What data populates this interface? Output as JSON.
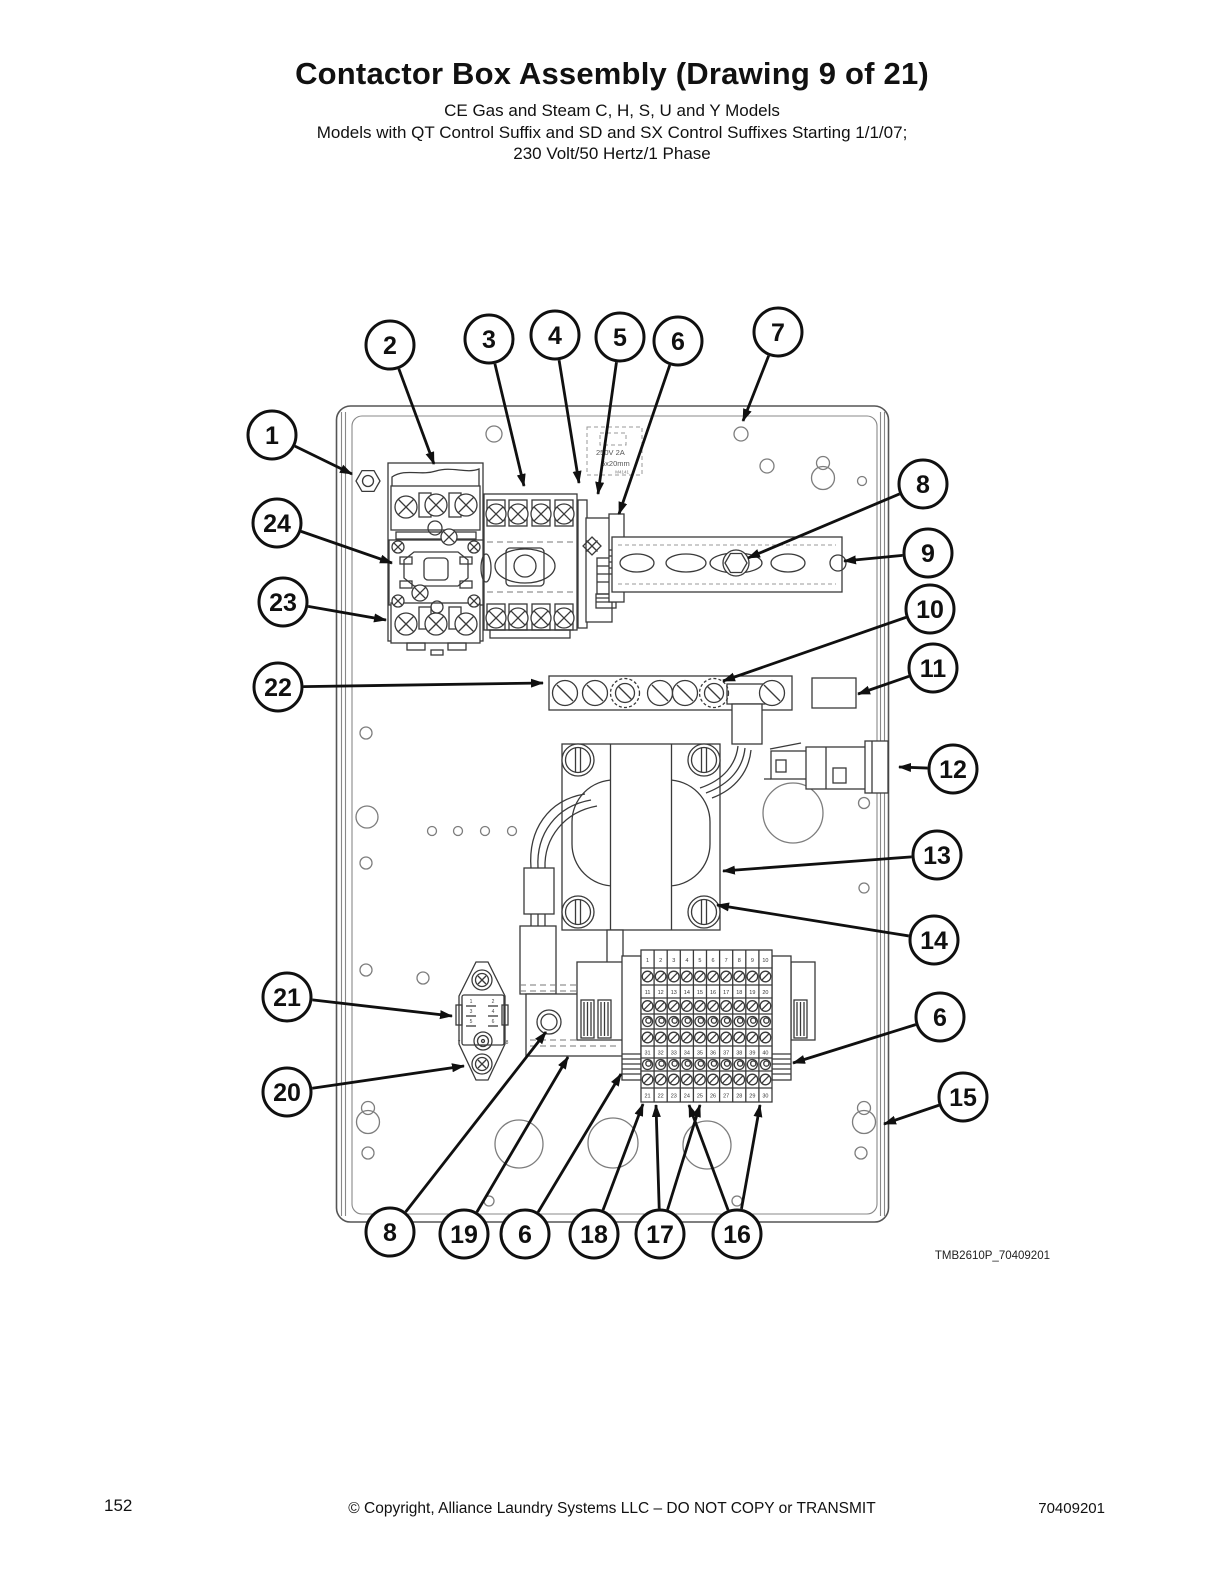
{
  "page": {
    "title": "Contactor Box Assembly (Drawing 9 of 21)",
    "subtitle_line1": "CE Gas and Steam C, H, S, U and Y Models",
    "subtitle_line2": "Models with QT Control Suffix and SD and SX Control Suffixes Starting 1/1/07;",
    "subtitle_line3": "230 Volt/50 Hertz/1 Phase",
    "drawing_code": "TMB2610P_70409201",
    "footer": {
      "page_number": "152",
      "copyright": "© Copyright, Alliance Laundry Systems LLC – DO NOT COPY or TRANSMIT",
      "document_number": "70409201"
    }
  },
  "diagram": {
    "fuse_label": {
      "line1": "250V 2A",
      "line2": "5x20mm",
      "line3": "M4141"
    },
    "inlet_pin_labels": [
      "1",
      "2",
      "3",
      "4",
      "5",
      "6",
      "7",
      "8"
    ],
    "terminal_block_rows": [
      [
        "1",
        "2",
        "3",
        "4",
        "5",
        "6",
        "7",
        "8",
        "9",
        "10"
      ],
      [
        "11",
        "12",
        "13",
        "14",
        "15",
        "16",
        "17",
        "18",
        "19",
        "20"
      ],
      [
        "31",
        "32",
        "33",
        "34",
        "35",
        "36",
        "37",
        "38",
        "39",
        "40"
      ],
      [
        "21",
        "22",
        "23",
        "24",
        "25",
        "26",
        "27",
        "28",
        "29",
        "30"
      ]
    ],
    "callouts": [
      {
        "label": "1",
        "x": 272,
        "y": 435,
        "targets": [
          [
            352,
            474
          ]
        ]
      },
      {
        "label": "2",
        "x": 390,
        "y": 345,
        "targets": [
          [
            434,
            464
          ]
        ]
      },
      {
        "label": "3",
        "x": 489,
        "y": 339,
        "targets": [
          [
            524,
            486
          ]
        ]
      },
      {
        "label": "4",
        "x": 555,
        "y": 335,
        "targets": [
          [
            579,
            483
          ]
        ]
      },
      {
        "label": "5",
        "x": 620,
        "y": 337,
        "targets": [
          [
            598,
            494
          ]
        ]
      },
      {
        "label": "6",
        "x": 678,
        "y": 341,
        "targets": [
          [
            619,
            514
          ]
        ]
      },
      {
        "label": "7",
        "x": 778,
        "y": 332,
        "targets": [
          [
            743,
            421
          ]
        ]
      },
      {
        "label": "8",
        "x": 923,
        "y": 484,
        "targets": [
          [
            748,
            558
          ]
        ]
      },
      {
        "label": "9",
        "x": 928,
        "y": 553,
        "targets": [
          [
            844,
            561
          ]
        ]
      },
      {
        "label": "10",
        "x": 930,
        "y": 609,
        "targets": [
          [
            723,
            681
          ]
        ]
      },
      {
        "label": "11",
        "x": 933,
        "y": 668,
        "targets": [
          [
            858,
            694
          ]
        ]
      },
      {
        "label": "12",
        "x": 953,
        "y": 769,
        "targets": [
          [
            899,
            767
          ]
        ]
      },
      {
        "label": "13",
        "x": 937,
        "y": 855,
        "targets": [
          [
            723,
            871
          ]
        ]
      },
      {
        "label": "14",
        "x": 934,
        "y": 940,
        "targets": [
          [
            717,
            905
          ]
        ]
      },
      {
        "label": "6",
        "x": 940,
        "y": 1017,
        "targets": [
          [
            793,
            1063
          ]
        ]
      },
      {
        "label": "15",
        "x": 963,
        "y": 1097,
        "targets": [
          [
            884,
            1124
          ]
        ]
      },
      {
        "label": "24",
        "x": 277,
        "y": 523,
        "targets": [
          [
            392,
            563
          ]
        ]
      },
      {
        "label": "23",
        "x": 283,
        "y": 602,
        "targets": [
          [
            386,
            620
          ]
        ]
      },
      {
        "label": "22",
        "x": 278,
        "y": 687,
        "targets": [
          [
            543,
            683
          ]
        ]
      },
      {
        "label": "21",
        "x": 287,
        "y": 997,
        "targets": [
          [
            452,
            1016
          ]
        ]
      },
      {
        "label": "20",
        "x": 287,
        "y": 1092,
        "targets": [
          [
            464,
            1066
          ]
        ]
      },
      {
        "label": "8",
        "x": 390,
        "y": 1232,
        "targets": [
          [
            546,
            1032
          ]
        ]
      },
      {
        "label": "19",
        "x": 464,
        "y": 1234,
        "targets": [
          [
            568,
            1057
          ]
        ]
      },
      {
        "label": "6",
        "x": 525,
        "y": 1234,
        "targets": [
          [
            621,
            1074
          ]
        ]
      },
      {
        "label": "18",
        "x": 594,
        "y": 1234,
        "targets": [
          [
            643,
            1104
          ]
        ]
      },
      {
        "label": "17",
        "x": 660,
        "y": 1234,
        "targets": [
          [
            656,
            1105
          ],
          [
            700,
            1105
          ]
        ]
      },
      {
        "label": "16",
        "x": 737,
        "y": 1234,
        "targets": [
          [
            689,
            1105
          ],
          [
            760,
            1105
          ]
        ]
      }
    ]
  }
}
